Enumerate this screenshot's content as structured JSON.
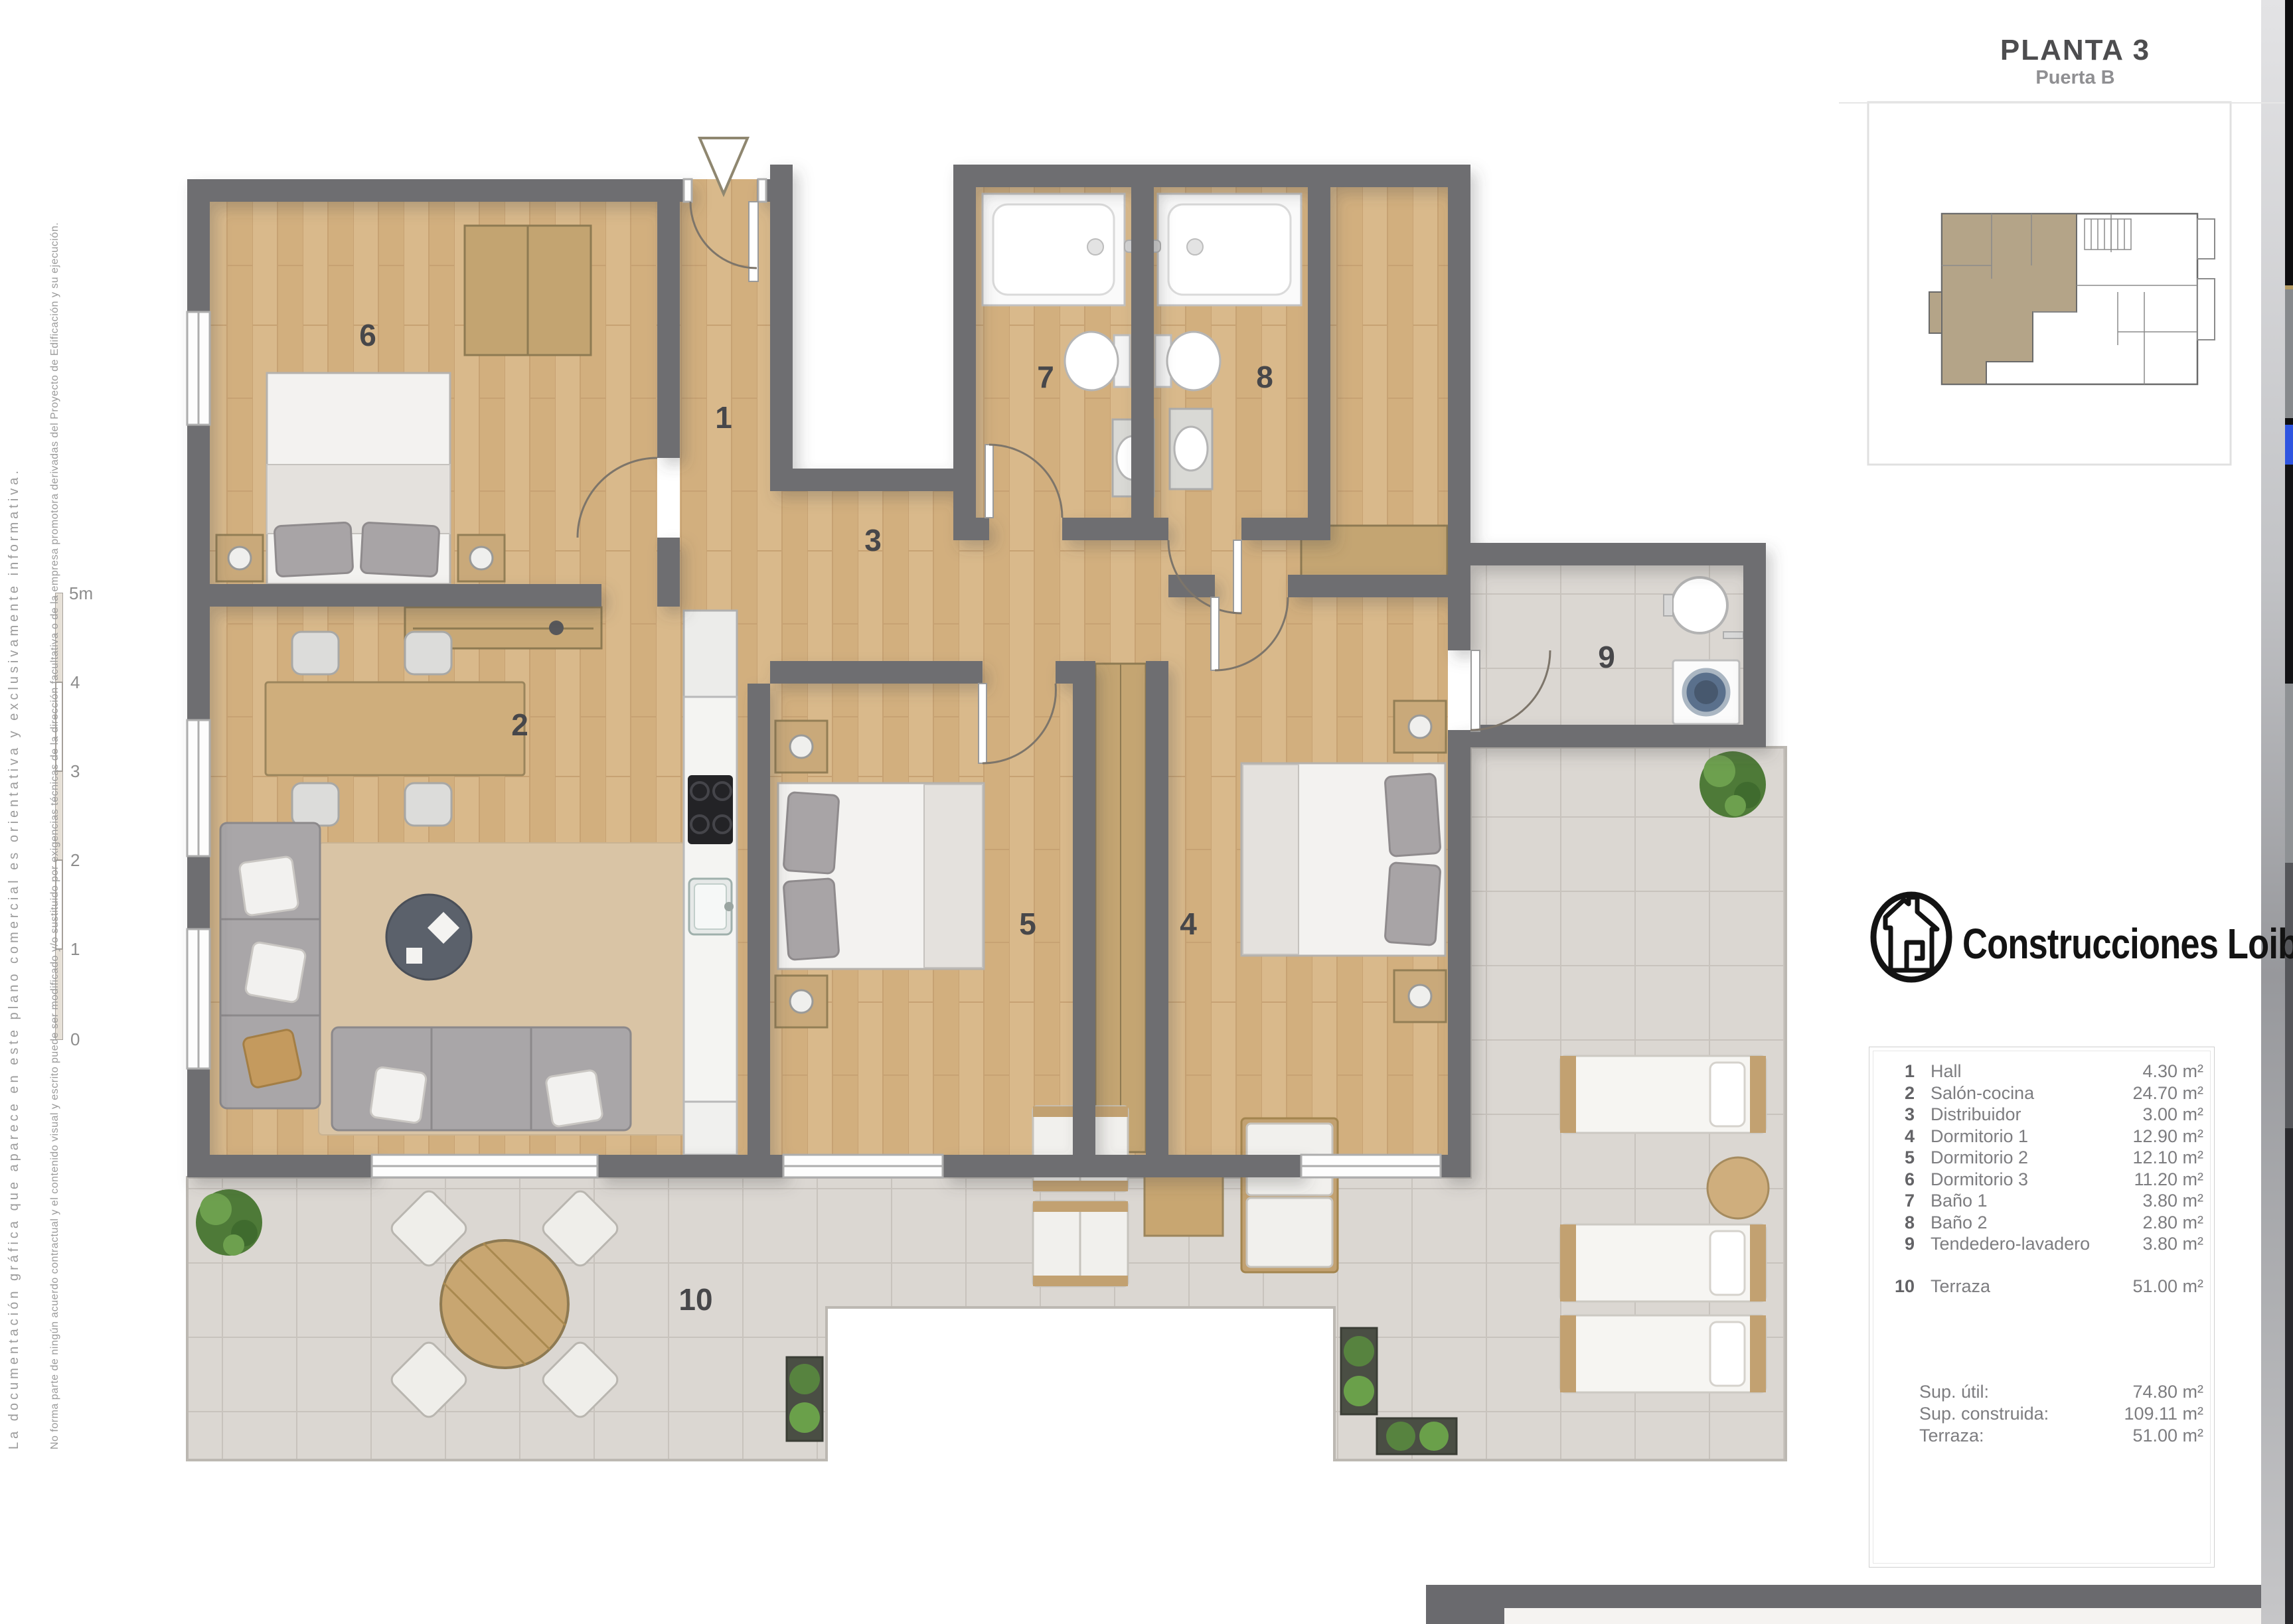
{
  "title": {
    "main": "PLANTA 3",
    "sub": "Puerta B"
  },
  "brand": {
    "name": "Construcciones Loibe"
  },
  "legend": {
    "items": [
      {
        "num": "1",
        "label": "Hall",
        "area": "4.30 m²"
      },
      {
        "num": "2",
        "label": "Salón-cocina",
        "area": "24.70 m²"
      },
      {
        "num": "3",
        "label": "Distribuidor",
        "area": "3.00 m²"
      },
      {
        "num": "4",
        "label": "Dormitorio 1",
        "area": "12.90 m²"
      },
      {
        "num": "5",
        "label": "Dormitorio 2",
        "area": "12.10 m²"
      },
      {
        "num": "6",
        "label": "Dormitorio 3",
        "area": "11.20 m²"
      },
      {
        "num": "7",
        "label": "Baño 1",
        "area": "3.80 m²"
      },
      {
        "num": "8",
        "label": "Baño 2",
        "area": "2.80 m²"
      },
      {
        "num": "9",
        "label": "Tendedero-lavadero",
        "area": "3.80 m²"
      },
      {
        "num": "10",
        "label": "Terraza",
        "area": "51.00 m²"
      }
    ],
    "totals": [
      {
        "label": "Sup. útil:",
        "value": "74.80 m²"
      },
      {
        "label": "Sup. construida:",
        "value": "109.11 m²"
      },
      {
        "label": "Terraza:",
        "value": "51.00 m²"
      }
    ]
  },
  "plan": {
    "room_labels": [
      "1",
      "2",
      "3",
      "4",
      "5",
      "6",
      "7",
      "8",
      "9",
      "10"
    ]
  },
  "scale_ruler": {
    "labels": [
      "5m",
      "4",
      "3",
      "2",
      "1",
      "0"
    ]
  },
  "disclaimer": {
    "line1": "La documentación gráfica que aparece en este plano comercial es orientativa y exclusivamente informativa.",
    "line2": "No forma parte de ningún acuerdo contractual y el contenido visual y escrito puede ser modificado y/o sustituido por exigencias técnicas de la dirección facultativa o de la empresa promotora derivadas del Proyecto de Edificación y su ejecución."
  },
  "colors": {
    "wall": "#6e6e71",
    "wood": "#d9b98b",
    "tile": "#dbd7d2",
    "highlight": "#b4a488",
    "brand": "#131313"
  }
}
